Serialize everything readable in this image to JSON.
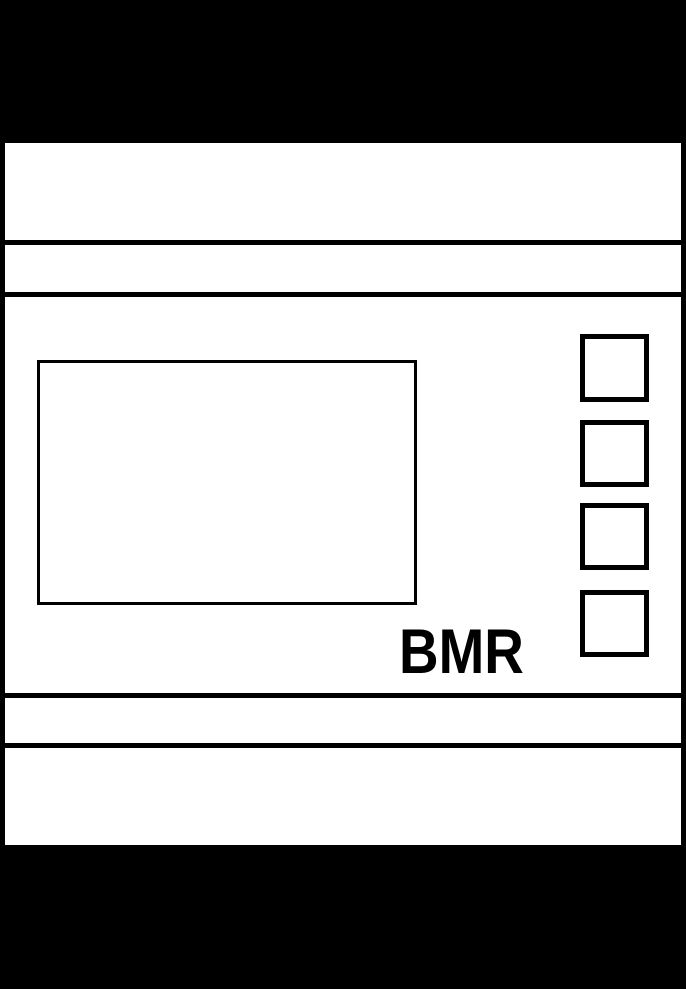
{
  "device": {
    "brand_label": "BMR",
    "colors": {
      "outline": "#000000",
      "panel_fill": "#ffffff",
      "page_background": "#000000"
    },
    "display": {
      "name": "lcd-display",
      "content": ""
    },
    "buttons": [
      {
        "name": "button-1",
        "label": ""
      },
      {
        "name": "button-2",
        "label": ""
      },
      {
        "name": "button-3",
        "label": ""
      },
      {
        "name": "button-4",
        "label": ""
      }
    ]
  }
}
